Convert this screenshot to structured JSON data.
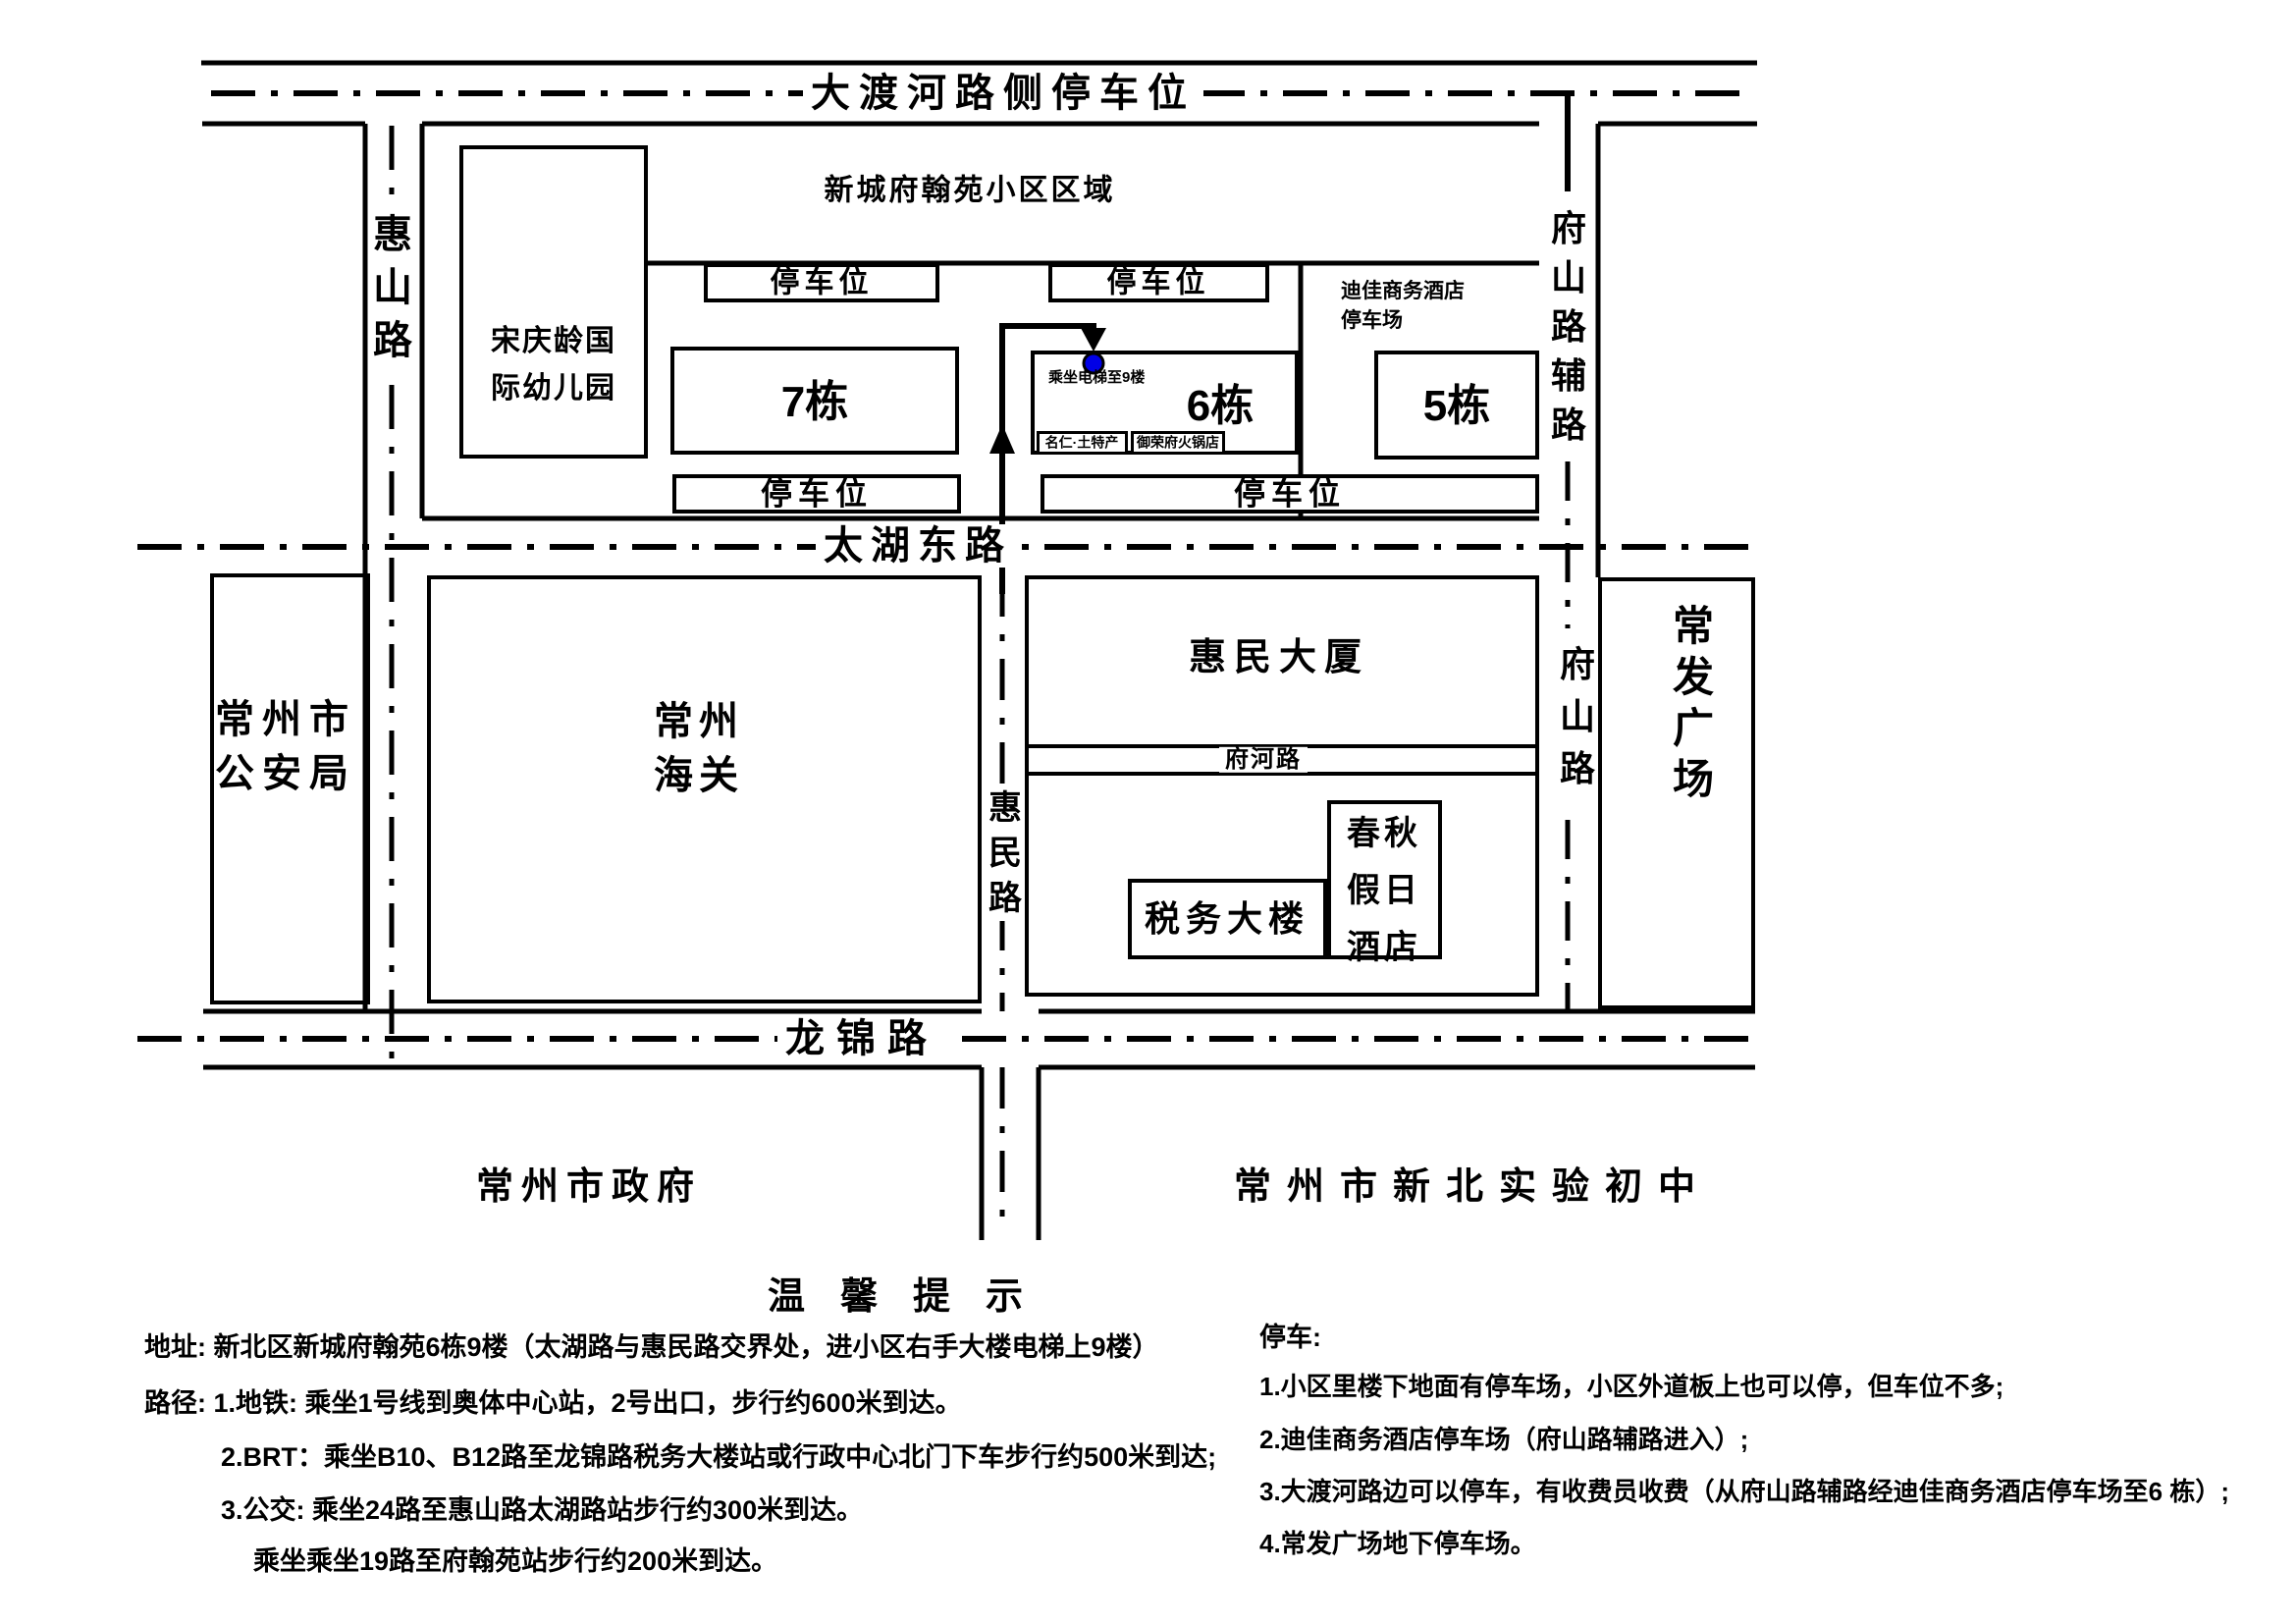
{
  "roads": {
    "daduhe": "大渡河路侧停车位",
    "huishan": "惠山路",
    "fushanfulu": "府山路辅路",
    "taihu": "太湖东路",
    "huimin": "惠民路",
    "fuhe": "府河路",
    "fushan": "府山路",
    "longjin": "龙锦路"
  },
  "community": {
    "area": "新城府翰苑小区区域",
    "kindergarten": "宋庆龄国际幼儿园",
    "parking": "停车位",
    "b7": "7栋",
    "b6": "6栋",
    "b5": "5栋",
    "dijia": "迪佳商务酒店停车场",
    "elevator": "乘坐电梯至9楼",
    "shop1": "名仁·土特产",
    "shop2": "御荣府火锅店"
  },
  "places": {
    "police": "常州市公安局",
    "customs": "常州海关",
    "huimin_building": "惠民大厦",
    "tax": "税务大楼",
    "hotel": "春秋假日酒店",
    "changfa": "常发广场",
    "gov": "常州市政府",
    "school": "常州市新北实验初中"
  },
  "notes": {
    "title": "温馨提示",
    "address": "地址: 新北区新城府翰苑6栋9楼（太湖路与惠民路交界处，进小区右手大楼电梯上9楼）",
    "route1": "路径: 1.地铁: 乘坐1号线到奥体中心站，2号出口，步行约600米到达。",
    "route2": "2.BRT：乘坐B10、B12路至龙锦路税务大楼站或行政中心北门下车步行约500米到达;",
    "route3": "3.公交: 乘坐24路至惠山路太湖路站步行约300米到达。",
    "route4": "乘坐乘坐19路至府翰苑站步行约200米到达。",
    "park_title": "停车:",
    "park1": "1.小区里楼下地面有停车场，小区外道板上也可以停，但车位不多;",
    "park2": "2.迪佳商务酒店停车场（府山路辅路进入）;",
    "park3": "3.大渡河路边可以停车，有收费员收费（从府山路辅路经迪佳商务酒店停车场至6 栋）;",
    "park4": "4.常发广场地下停车场。"
  },
  "colors": {
    "line": "#000000",
    "marker_blue": "#0000e6"
  }
}
